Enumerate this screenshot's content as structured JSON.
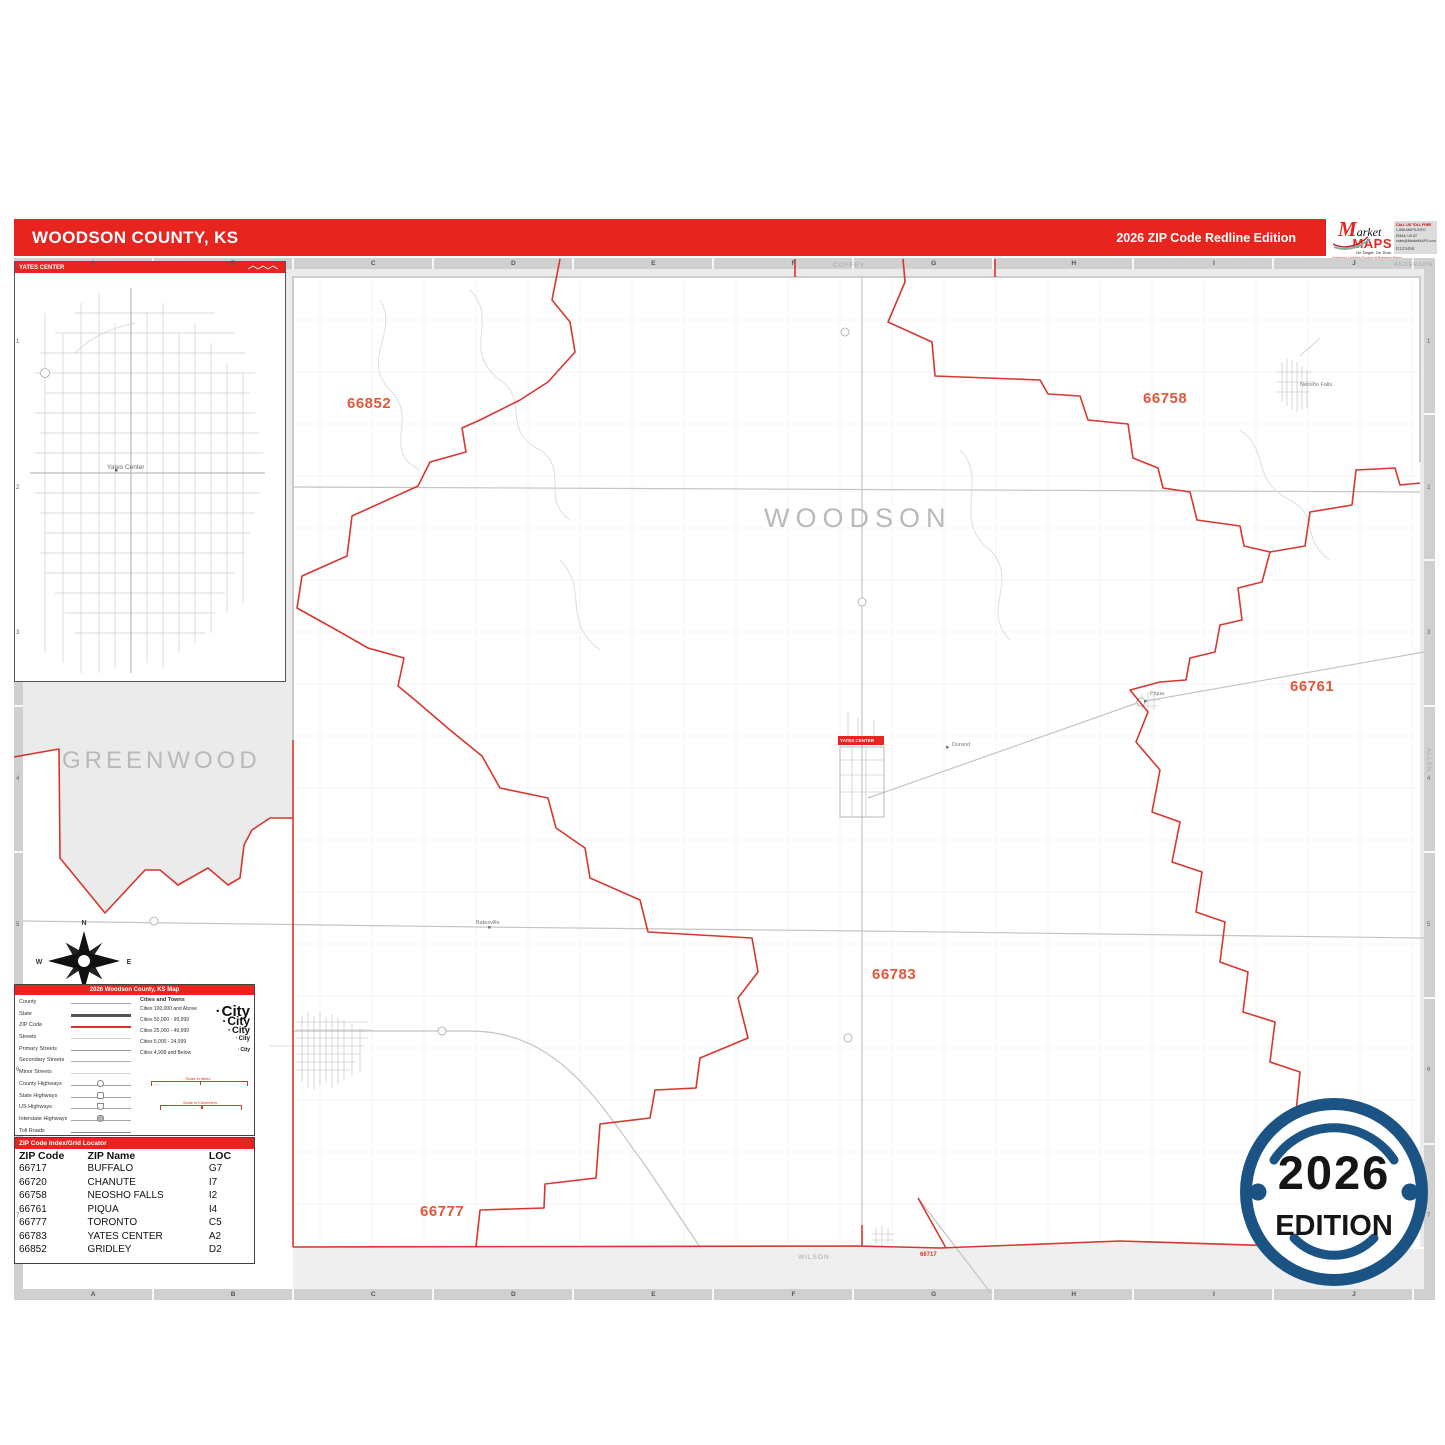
{
  "header": {
    "title": "WOODSON COUNTY, KS",
    "edition": "2026 ZIP Code Redline Edition"
  },
  "logo": {
    "market": "Market",
    "maps": "MAPS",
    "tagline": "On Target.  On Time.",
    "subtitle": "America's Leading Source of Business Maps",
    "contact_lines": [
      "CALL US TOLL FREE",
      "1-888-MAPS-INFO",
      "EMAIL US AT",
      "sales@MarketMAPS.com"
    ],
    "product_code": "D123456"
  },
  "colors": {
    "header_red": "#e8241f",
    "boundary_red": "#d6372f",
    "zip_label": "#e0573a",
    "badge_navy": "#1b5384",
    "outside_gray": "#ebebeb"
  },
  "inset": {
    "title": "YATES CENTER",
    "city": "Yates Center"
  },
  "map": {
    "county": "WOODSON",
    "neighbors": {
      "west": "GREENWOOD",
      "north": "COFFEY",
      "northeast": "ANDERSON",
      "east": "ALLEN",
      "south": "WILSON"
    },
    "grid_cols": [
      "A",
      "B",
      "C",
      "D",
      "E",
      "F",
      "G",
      "H",
      "I",
      "J"
    ],
    "grid_rows": [
      "1",
      "2",
      "3",
      "4",
      "5",
      "6",
      "7"
    ],
    "zip_labels": [
      "66852",
      "66758",
      "66761",
      "66783",
      "66777"
    ],
    "zip_small_label": "66717",
    "towns": {
      "neosho_falls": "Neosho Falls",
      "durand": "Durand",
      "batesville": "Batesville",
      "piqua": "Piqua"
    },
    "city_box": "YATES CENTER",
    "compass": {
      "n": "N",
      "e": "E",
      "s": "S",
      "w": "W"
    }
  },
  "legend": {
    "title": "2026 Woodson County, KS Map",
    "line_items": [
      "County",
      "State",
      "ZIP Code",
      "Streets",
      "Primary Streets",
      "Secondary Streets",
      "Minor Streets",
      "County Highways",
      "State Highways",
      "US Highways",
      "Interstate Highways",
      "Toll Roads"
    ],
    "cities_header": "Cities and Towns",
    "city_classes": [
      "Cities 100,000 and Above",
      "Cities 50,000 - 99,999",
      "Cities 25,000 - 49,999",
      "Cities 5,000 - 24,999",
      "Cities 4,999 and Below"
    ],
    "city_sample_word": "City",
    "scale_miles": "Scale in Miles",
    "scale_km": "Scale in Kilometers"
  },
  "zip_table": {
    "title": "ZIP Code Index/Grid Locator",
    "columns": [
      "ZIP Code",
      "ZIP Name",
      "LOC"
    ],
    "rows": [
      [
        "66717",
        "BUFFALO",
        "G7"
      ],
      [
        "66720",
        "CHANUTE",
        "I7"
      ],
      [
        "66758",
        "NEOSHO FALLS",
        "I2"
      ],
      [
        "66761",
        "PIQUA",
        "I4"
      ],
      [
        "66777",
        "TORONTO",
        "C5"
      ],
      [
        "66783",
        "YATES CENTER",
        "A2"
      ],
      [
        "66852",
        "GRIDLEY",
        "D2"
      ]
    ]
  },
  "badge": {
    "year": "2026",
    "word": "EDITION"
  }
}
